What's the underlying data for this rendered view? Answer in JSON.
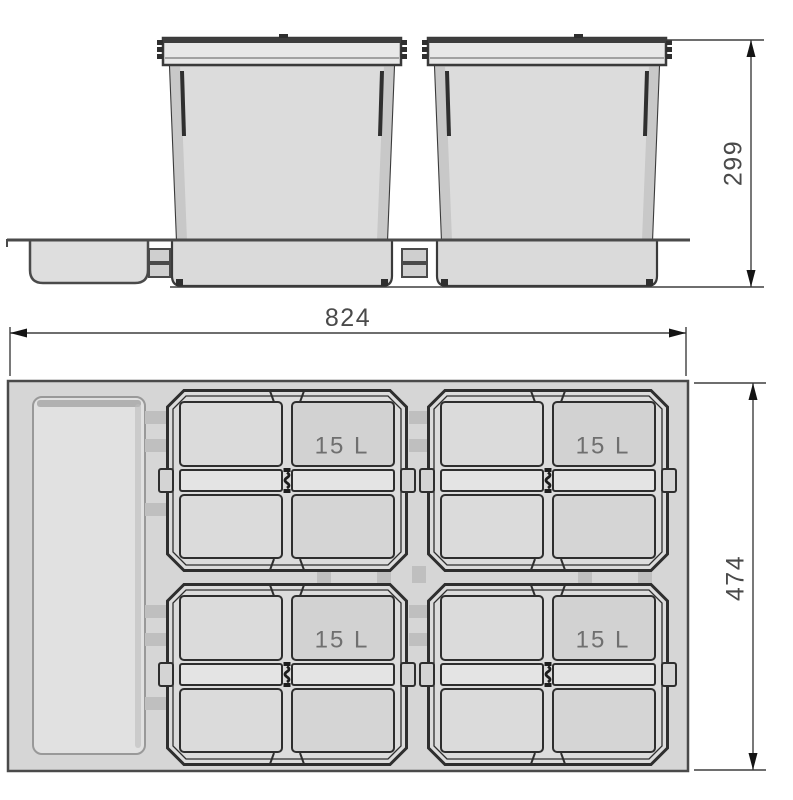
{
  "drawing": {
    "front_view": {
      "dimension_height": "299",
      "bin_count": 2
    },
    "plan_view": {
      "dimension_width": "824",
      "dimension_depth": "474",
      "bins": [
        {
          "capacity": "15 L"
        },
        {
          "capacity": "15 L"
        },
        {
          "capacity": "15 L"
        },
        {
          "capacity": "15 L"
        }
      ]
    },
    "colors": {
      "background": "#ffffff",
      "drawer_fill": "#d6d6d6",
      "tray_fill": "#e1e1e1",
      "bin_fill": "#dcdcdc",
      "panel_dark_fill": "#d2d2d2",
      "band_fill": "#e4e4e4",
      "lid_fill": "#e8e8e8",
      "outline": "#2e2e2e",
      "dimension_line": "#3f3f3f",
      "dimension_text": "#4a4a4a",
      "label_text": "#6f6f6f"
    }
  }
}
